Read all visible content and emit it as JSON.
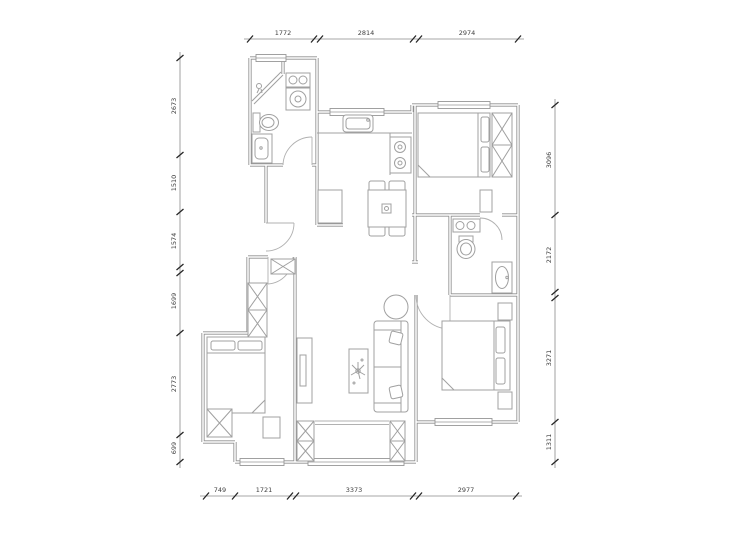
{
  "drawing": {
    "kind": "residential floor plan",
    "dims": {
      "top": [
        "1772",
        "2814",
        "2974"
      ],
      "bottom": [
        "749",
        "1721",
        "3373",
        "2977"
      ],
      "left": [
        "2673",
        "1510",
        "1574",
        "1699",
        "2773",
        "699"
      ],
      "right": [
        "3096",
        "2172",
        "3271",
        "1311"
      ]
    },
    "symbols": [
      "shower-icon",
      "toilet-icon",
      "washing-machine-icon",
      "basin-icon",
      "kitchen-sink-icon",
      "stove-icon",
      "dining-table-icon",
      "chair-icon",
      "sofa-icon",
      "coffee-table-icon",
      "round-table-icon",
      "tv-cabinet-icon",
      "bed-icon",
      "pillow-icon",
      "wardrobe-icon",
      "nightstand-icon",
      "window-icon",
      "door-swing-icon",
      "cabinet-x-icon"
    ],
    "colors": {
      "wall": "#8f8f8f",
      "furniture": "#a0a0a0",
      "dimension_line": "#8a8a8a",
      "tick": "#262626",
      "text": "#3f3f3f",
      "background": "#ffffff"
    }
  }
}
